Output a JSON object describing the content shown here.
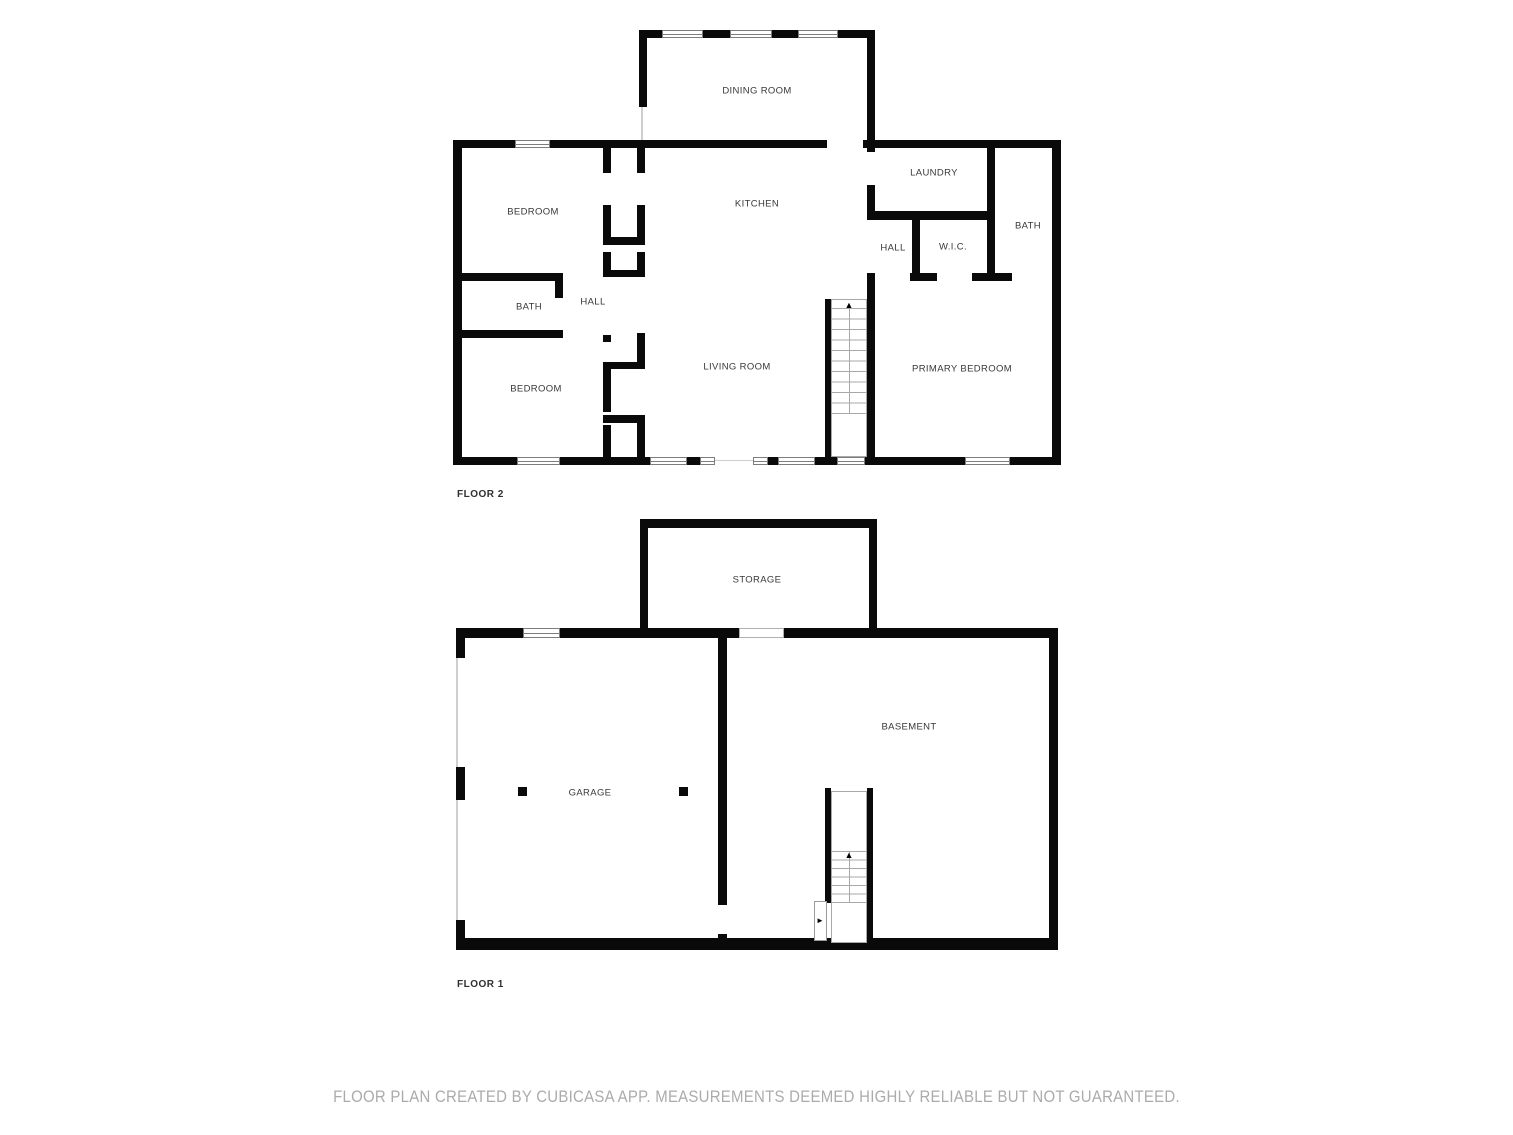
{
  "title": "Two-floor residential floor plan",
  "colors": {
    "background": "#ffffff",
    "wall": "#0a0a0a",
    "room_label": "#383838",
    "floor_label": "#2f2f2f",
    "footer_text": "#ababab",
    "window_border": "#7d7d7d",
    "stair_line": "#a8a8a8"
  },
  "icons": {
    "stairs_up_arrow": "▲",
    "door_direction_arrow": "►"
  },
  "floors": [
    {
      "label": "FLOOR 2",
      "rooms": [
        {
          "label": "DINING ROOM"
        },
        {
          "label": "BEDROOM"
        },
        {
          "label": "KITCHEN"
        },
        {
          "label": "LAUNDRY"
        },
        {
          "label": "HALL"
        },
        {
          "label": "W.I.C."
        },
        {
          "label": "BATH"
        },
        {
          "label": "BATH"
        },
        {
          "label": "HALL"
        },
        {
          "label": "BEDROOM"
        },
        {
          "label": "LIVING ROOM"
        },
        {
          "label": "PRIMARY BEDROOM"
        }
      ]
    },
    {
      "label": "FLOOR 1",
      "rooms": [
        {
          "label": "STORAGE"
        },
        {
          "label": "GARAGE"
        },
        {
          "label": "BASEMENT"
        }
      ]
    }
  ],
  "footer": {
    "text": "FLOOR PLAN CREATED BY CUBICASA APP. MEASUREMENTS DEEMED HIGHLY RELIABLE BUT NOT GUARANTEED."
  }
}
